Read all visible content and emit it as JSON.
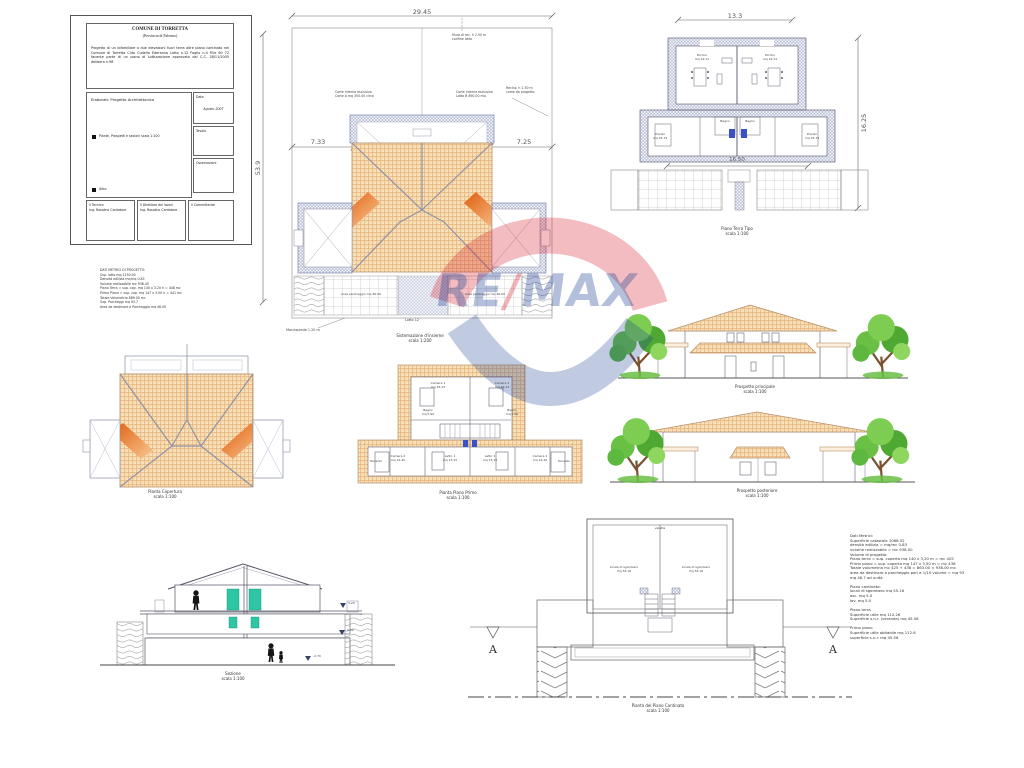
{
  "title_block": {
    "commune": "COMUNE DI TORRETTA",
    "province": "(Provincia di Palermo)",
    "description": "Progetto di un bifamiliare a due elevazioni fuori terra oltre piano cantinato nel Comune di Torretta C/da Cudella Ederanno Lotto n.12 Foglio n.4 P.lle 60 72 facente parte di un piano di Lottizzazione approvato dal C.C. 28/11/2005 delibera n.98",
    "elaborati_heading": "Elaborati: Progetto Architettonico",
    "item1": "Piante, Prospetti e sezioni scala 1:100",
    "item2": "Altro",
    "data_label": "Data",
    "data_value": "Agosto 2007",
    "tavola_label": "Tavola",
    "osservazioni_label": "Osservazioni",
    "tecnico_label": "Il Tecnico",
    "tecnico_name": "Ing. Rosolino Cantatore",
    "direttore_label": "Il Direttore dei lavori",
    "direttore_name": "Ing. Rosolino Cantatore",
    "committente_label": "Il Committente"
  },
  "note_block": {
    "lines": [
      "DATI METRICI DI PROGETTO:",
      "Sup. lotto mq 1150.00",
      "Densità edilizia mc/mq 0.83",
      "Volume realizzabile mc 938.45",
      "Piano Terra = sup. cop. mq 140 x 3.20 h = 448 mc",
      "Primo Piano = sup. cop. mq 147 x 3.00 h = 441 mc",
      "Totale Volumetria 889.00 mc",
      "Sup. Parcheggi mq 93.7",
      "Area da destinare a Parcheggio mq 46.00"
    ]
  },
  "site_plan": {
    "dim_width": "29.45",
    "dim_height": "53.9",
    "dim_left": "7.33",
    "dim_right": "7.25",
    "ann_top": "Muro di rec. h 2.50 m\nconfine lotto",
    "ann_left": "Corte interna esclusiva\nCorte A mq 300.00 circa",
    "ann_right": "Corte interna esclusiva\nLotto B 890.00 mq",
    "ann_fence": "Recinz. h 1.50 m\ncome da progetto",
    "label_parking_left": "Area parcheggio mq 46.00",
    "label_parking_right": "Area parcheggio mq 46.00",
    "label_sidewalk": "Marciapiede 1.20 m",
    "label_lotto": "Lotto 12",
    "caption": "Sistemazione d'insieme\nscala 1:200"
  },
  "ground_floor_plan": {
    "dim_top": "13.3",
    "dim_right": "16.25",
    "dim_mid": "16.50",
    "room_portico_left": "Portico\nmq 19.11",
    "room_portico_right": "Portico\nmq 19.11",
    "room_pranzo_left": "Pranzo\nmq 23.74",
    "room_pranzo_right": "Pranzo\nmq 23.74",
    "room_bagno_left": "Bagno",
    "room_bagno_right": "Bagno",
    "caption": "Piano Terra Tipo\nscala 1:100"
  },
  "roof_plan": {
    "caption": "Pianta Copertura\nscala 1:100"
  },
  "first_floor_plan": {
    "labels": [
      "Camera 1\nmq 16.13",
      "Camera 1\nmq 16.13",
      "Bagno\nmq 5.90",
      "Bagno\nmq 5.90",
      "Camera 2\nmq 14.20",
      "Camera 2\nmq 14.20",
      "Letto 1\nmq 13.15",
      "Letto 1\nmq 13.15",
      "Terrazzo",
      "Terrazzo"
    ],
    "caption": "Pianta Piano Primo\nscala 1:100"
  },
  "elevation_front": {
    "caption": "Prospetto principale\nscala 1:100"
  },
  "elevation_rear": {
    "caption": "Prospetto posteriore\nscala 1:100"
  },
  "section": {
    "caption": "Sezione\nscala 1:100",
    "levels": [
      "3.20",
      "0.00",
      "-2.70"
    ]
  },
  "basement_plan": {
    "label_top": "veletta",
    "label_left": "locale di sgombero\nmq 55.16",
    "label_right": "locale di sgombero\nmq 55.16",
    "marker": "A",
    "caption": "Pianta del Piano Cantinato\nscala 1:100"
  },
  "metric_block": {
    "lines": [
      "Dati Metrici:",
      "Superficie catastale 1068.52",
      "densità edilizia = mq/mc 0.83",
      "volume realizzabile = mc 938.00",
      "Volume di progetto:",
      "Piano terra = sup. coperta mq 140 x 3,20 m = mc 425",
      "Primo piano = sup. coperta mq 147 x 3,50 m = mc 438",
      "Totale volumetria mc 425 + 438 = 863.00 < 938.00 mc",
      "area da destinare a parcheggio pari a 1/10 volume = mq 93",
      "mq 46.7 ad unità",
      "",
      "Piano cantinato:",
      "locali di sgombero mq 55.16",
      "asc. mq 5.0",
      "lav. mq 5.0",
      "",
      "Piano terra",
      "Superficie utile mq 112.26",
      "Superficie s.n.r. (veranda) mq 45.56",
      "",
      "Primo piano",
      "Superficie utile abitabile mq 112.6",
      "superficie s.n.r. mq 45.56"
    ]
  },
  "watermark": {
    "re": "RE",
    "slash": "/",
    "max": "MAX",
    "red": "#d5212e",
    "blue": "#1b3f94"
  }
}
